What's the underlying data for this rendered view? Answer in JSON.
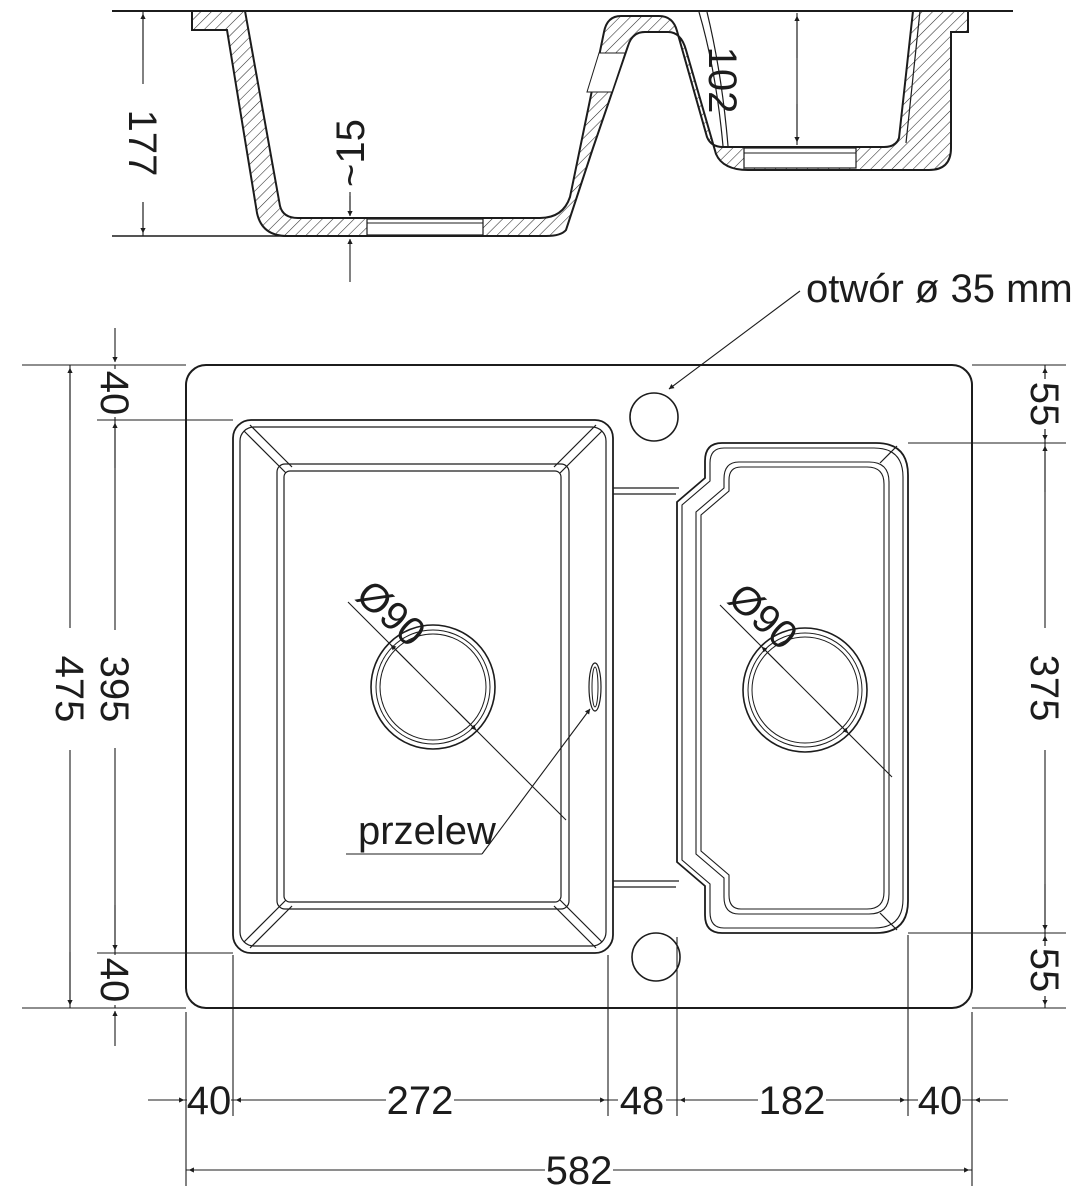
{
  "drawing": {
    "type": "kitchen-sink technical drawing, 1.5 bowl, cross-section and plan view",
    "labels": {
      "tap_hole": "otwór ø 35 mm",
      "overflow": "przelew"
    },
    "section_dims": {
      "depth": "177",
      "bottom_thickness": "~15",
      "bowl2_depth": "102"
    },
    "plan_dims": {
      "top_margin": "40",
      "bowl1_h": "395",
      "total_h": "475",
      "bottom_margin": "40",
      "right_top": "55",
      "bowl2_h": "375",
      "right_bottom": "55",
      "left_margin": "40",
      "bowl1_w": "272",
      "divider_w": "48",
      "bowl2_w": "182",
      "right_margin": "40",
      "total_w": "582",
      "drain1": "Ø90",
      "drain2": "Ø90"
    }
  }
}
